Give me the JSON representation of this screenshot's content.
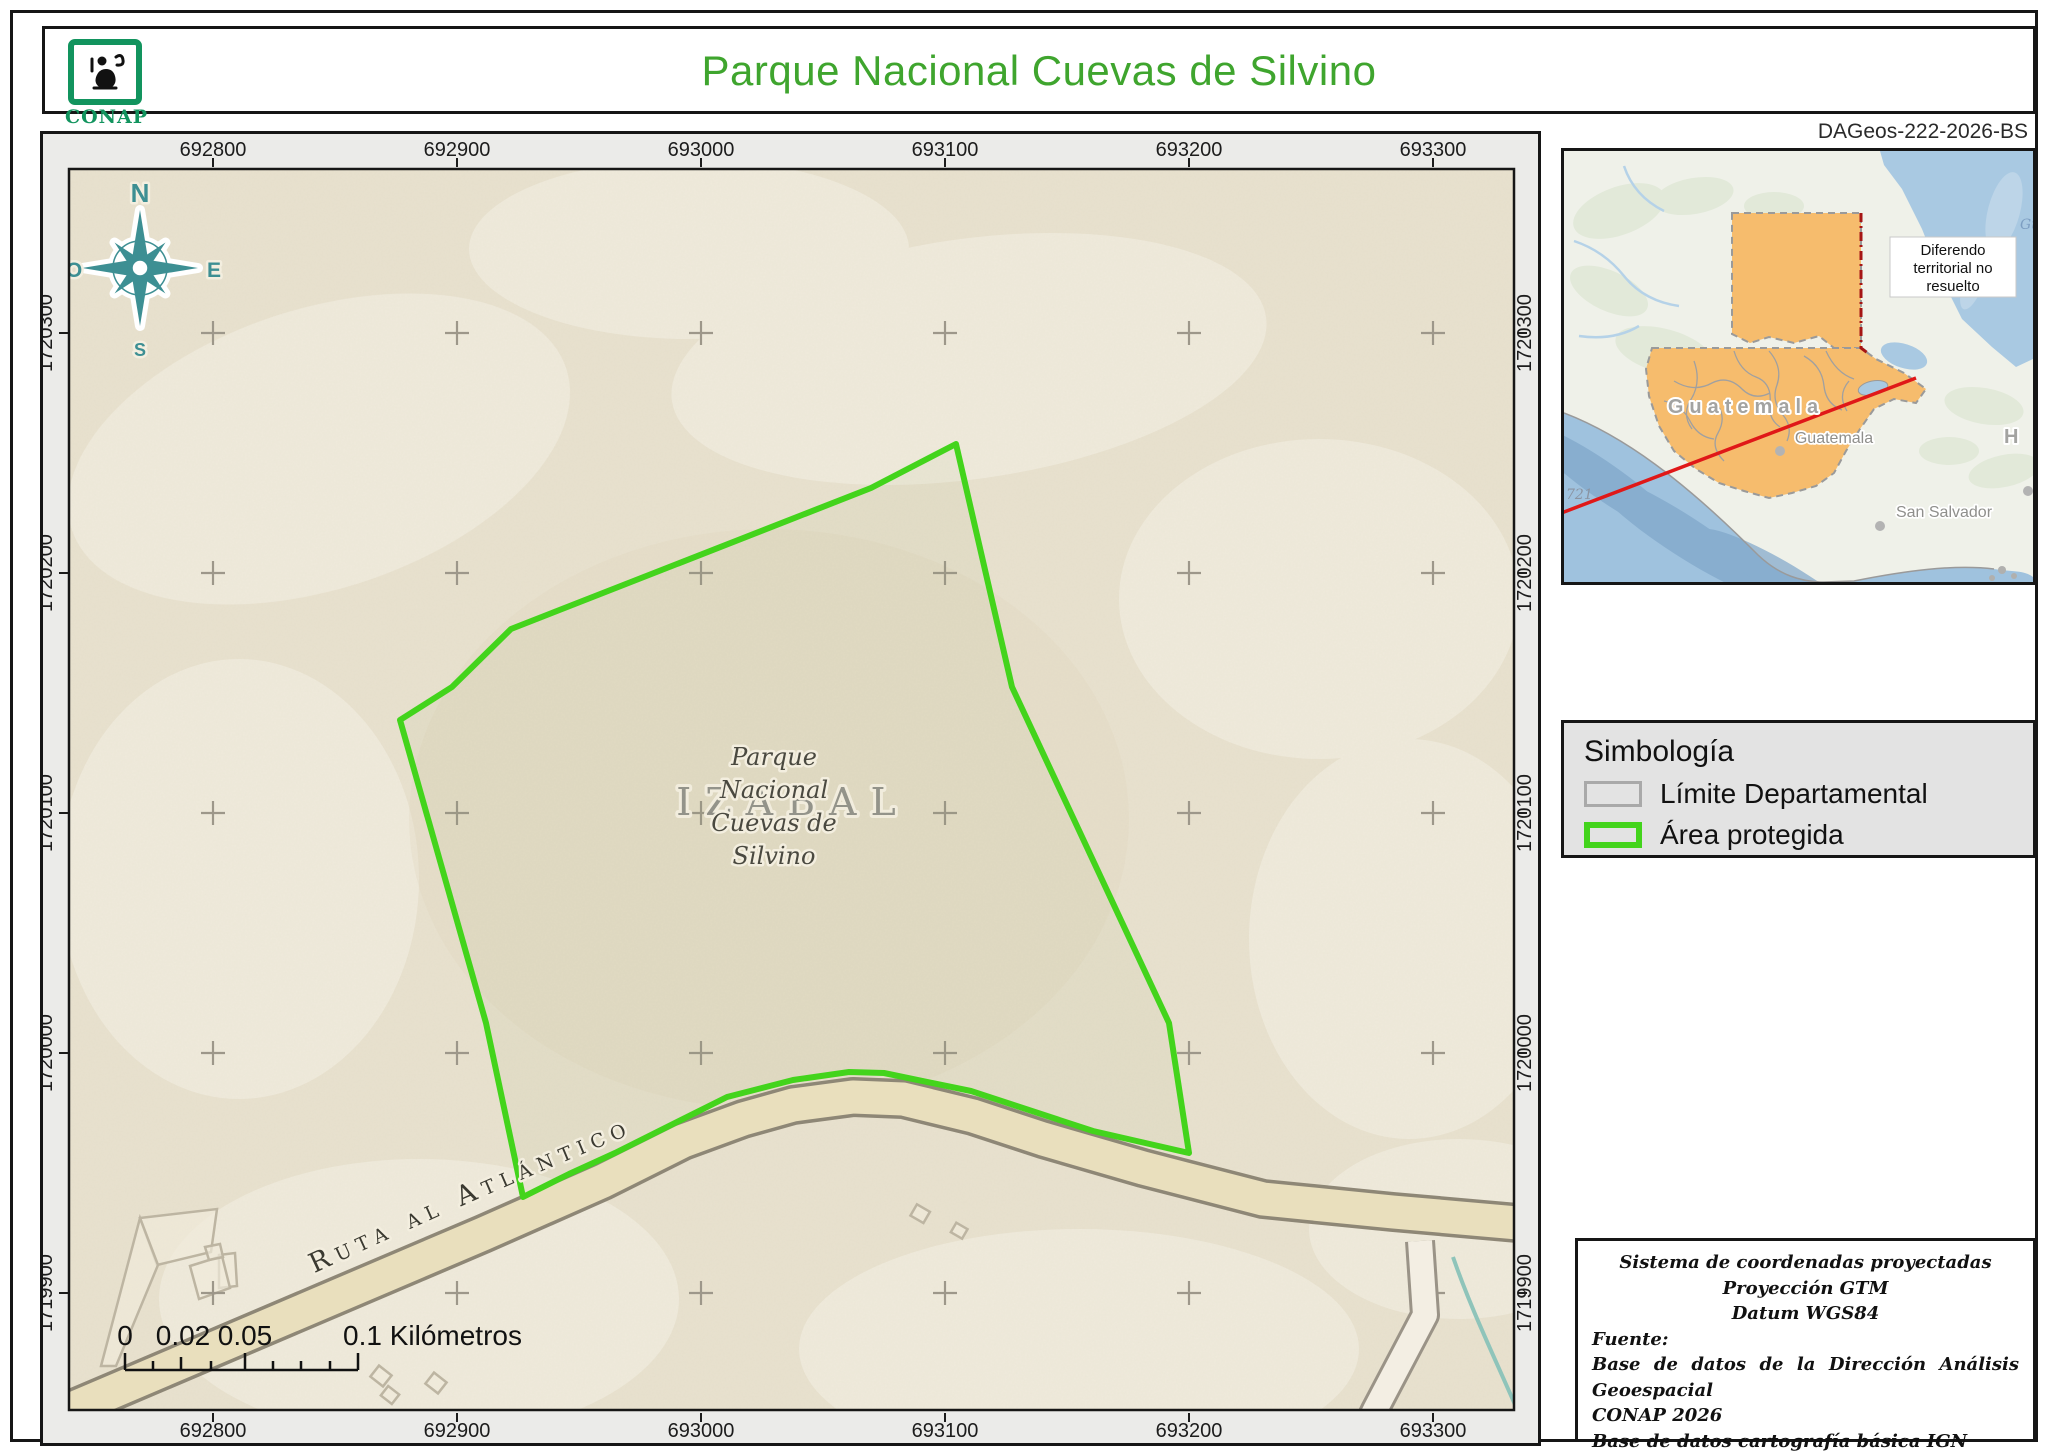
{
  "header": {
    "logo_text": "CONAP",
    "title": "Parque Nacional Cuevas de Silvino",
    "reference": "DAGeos-222-2026-BS"
  },
  "map": {
    "top_coords": [
      "692800",
      "692900",
      "693000",
      "693100",
      "693200",
      "693300"
    ],
    "bottom_coords": [
      "692800",
      "692900",
      "693000",
      "693100",
      "693200",
      "693300"
    ],
    "left_coords": [
      "1720300",
      "1720200",
      "1720100",
      "1720000",
      "1719900"
    ],
    "right_coords": [
      "1720300",
      "1720200",
      "1720100",
      "1720000",
      "1719900"
    ],
    "compass": {
      "n": "N",
      "e": "E",
      "s": "S",
      "o": "O"
    },
    "area_label": {
      "lines": [
        "Parque",
        "Nacional",
        "Cuevas de",
        "Silvino"
      ]
    },
    "department_label": "IZABAL",
    "road_label": "Ruta al Atlántico",
    "scale_bar": {
      "labels": [
        "0",
        "0.02",
        "0.05",
        "0.1"
      ],
      "unit": "Kilómetros"
    }
  },
  "inset": {
    "country_label": "Guatemala",
    "city_label": "Guatemala",
    "capital2_label": "San Salvador",
    "honduras_partial": "H o",
    "graticule_label": "721",
    "ocean_label_1": "Gu",
    "ocean_label_2": "Hond",
    "note_lines": [
      "Diferendo",
      "territorial no",
      "resuelto"
    ]
  },
  "legend": {
    "title": "Simbología",
    "items": [
      {
        "label": "Límite Departamental",
        "swatch": "gray-outline"
      },
      {
        "label": "Área protegida",
        "swatch": "green-outline"
      }
    ]
  },
  "info_box": {
    "lines": [
      "Sistema de coordenadas proyectadas",
      "Proyección GTM",
      "Datum WGS84"
    ],
    "source_label": "Fuente:",
    "source_lines": [
      "Base de datos de la Dirección Análisis Geoespacial",
      "CONAP 2026",
      "Base de datos cartografía básica IGN 2010"
    ]
  },
  "colors": {
    "title_green": "#3fa52e",
    "conap_green": "#12945e",
    "protected_area_green": "#43d41c",
    "department_swatch_gray": "#a9a9a9",
    "guatemala_orange": "#f6bc6d",
    "leader_red": "#e01818",
    "compass_teal": "#3d8f93",
    "map_beige": "#e9e2cf",
    "road_beige": "#e9dfbd"
  }
}
